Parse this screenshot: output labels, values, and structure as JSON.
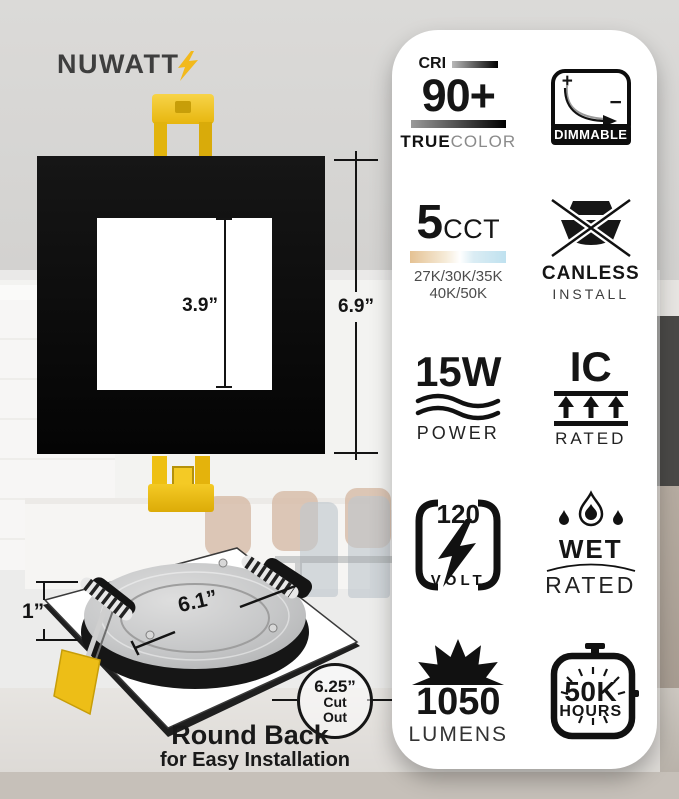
{
  "brand": {
    "name": "NUWATT",
    "accent_yellow": "#f2b91c"
  },
  "diagram": {
    "inner_dimension": "3.9”",
    "outer_dimension": "6.9”"
  },
  "product": {
    "diameter": "6.1”",
    "depth": "1”",
    "cutout_size": "6.25”",
    "cutout_word1": "Cut",
    "cutout_word2": "Out",
    "caption_title": "Round Back",
    "caption_subtitle": "for Easy Installation"
  },
  "badges": {
    "cri": {
      "label": "CRI",
      "value": "90+",
      "sub_bold": "TRUE",
      "sub_light": "COLOR"
    },
    "dimmable": {
      "plus": "+",
      "minus": "−",
      "label": "DIMMABLE"
    },
    "cct": {
      "value": "5",
      "unit": "CCT",
      "line1": "27K/30K/35K",
      "line2": "40K/50K",
      "warm_color": "#e5c293",
      "cool_color": "#bfe1ef"
    },
    "canless": {
      "line1": "CANLESS",
      "line2": "INSTALL"
    },
    "power": {
      "value": "15W",
      "label": "POWER"
    },
    "ic": {
      "value": "IC",
      "label": "RATED"
    },
    "volt": {
      "value": "120",
      "label": "VOLT"
    },
    "wet": {
      "line1": "WET",
      "line2": "RATED"
    },
    "lumens": {
      "value": "1050",
      "label": "LUMENS"
    },
    "hours": {
      "line1": "50K",
      "line2": "HOURS"
    }
  }
}
